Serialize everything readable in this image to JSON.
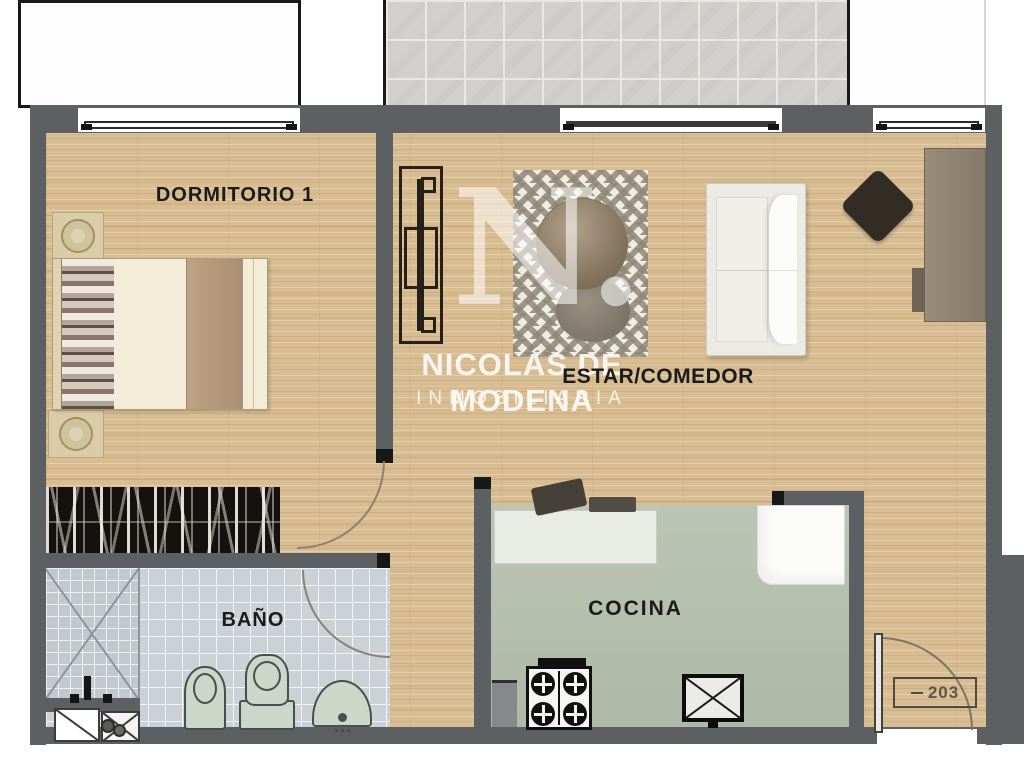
{
  "document": {
    "type": "apartment-floor-plan"
  },
  "rooms": {
    "bedroom": {
      "label": "DORMITORIO 1"
    },
    "living_dining": {
      "label": "ESTAR/COMEDOR"
    },
    "bathroom": {
      "label": "BAÑO"
    },
    "kitchen": {
      "label": "COCINA"
    }
  },
  "entry_door": {
    "unit_number": "203"
  },
  "watermark": {
    "monogram": "N.",
    "agency_name": "NICOLÁS DE MODENA",
    "agency_subtitle": "INMOBILIARIA"
  },
  "colors": {
    "wall": "#5c6063",
    "wood_floor": "#d8bd92",
    "bathroom_tile": "#cbd1d4",
    "kitchen_floor": "#b6c0ae",
    "terrace_tile": "#d2d0cc",
    "fixture_fill": "#ccd6c9",
    "closet_fill": "#14110e",
    "door_arc": "#8b8173"
  },
  "fixtures": {
    "bedroom": [
      "double-bed",
      "nightstand-with-lamp",
      "nightstand-with-lamp",
      "wardrobe-closet"
    ],
    "living_dining": [
      "tv-unit",
      "area-rug",
      "round-table",
      "pouf",
      "sofa",
      "dining-chair",
      "desk"
    ],
    "kitchen": [
      "counter",
      "coffee-machine",
      "microwave",
      "refrigerator",
      "stove-4-burners",
      "sink"
    ],
    "bathroom": [
      "shower",
      "shower-faucet",
      "bidet",
      "toilet",
      "washbasin",
      "vent-shaft",
      "washing-machine"
    ],
    "exterior": [
      "patio",
      "tiled-terrace",
      "window",
      "sliding-door",
      "window"
    ]
  }
}
